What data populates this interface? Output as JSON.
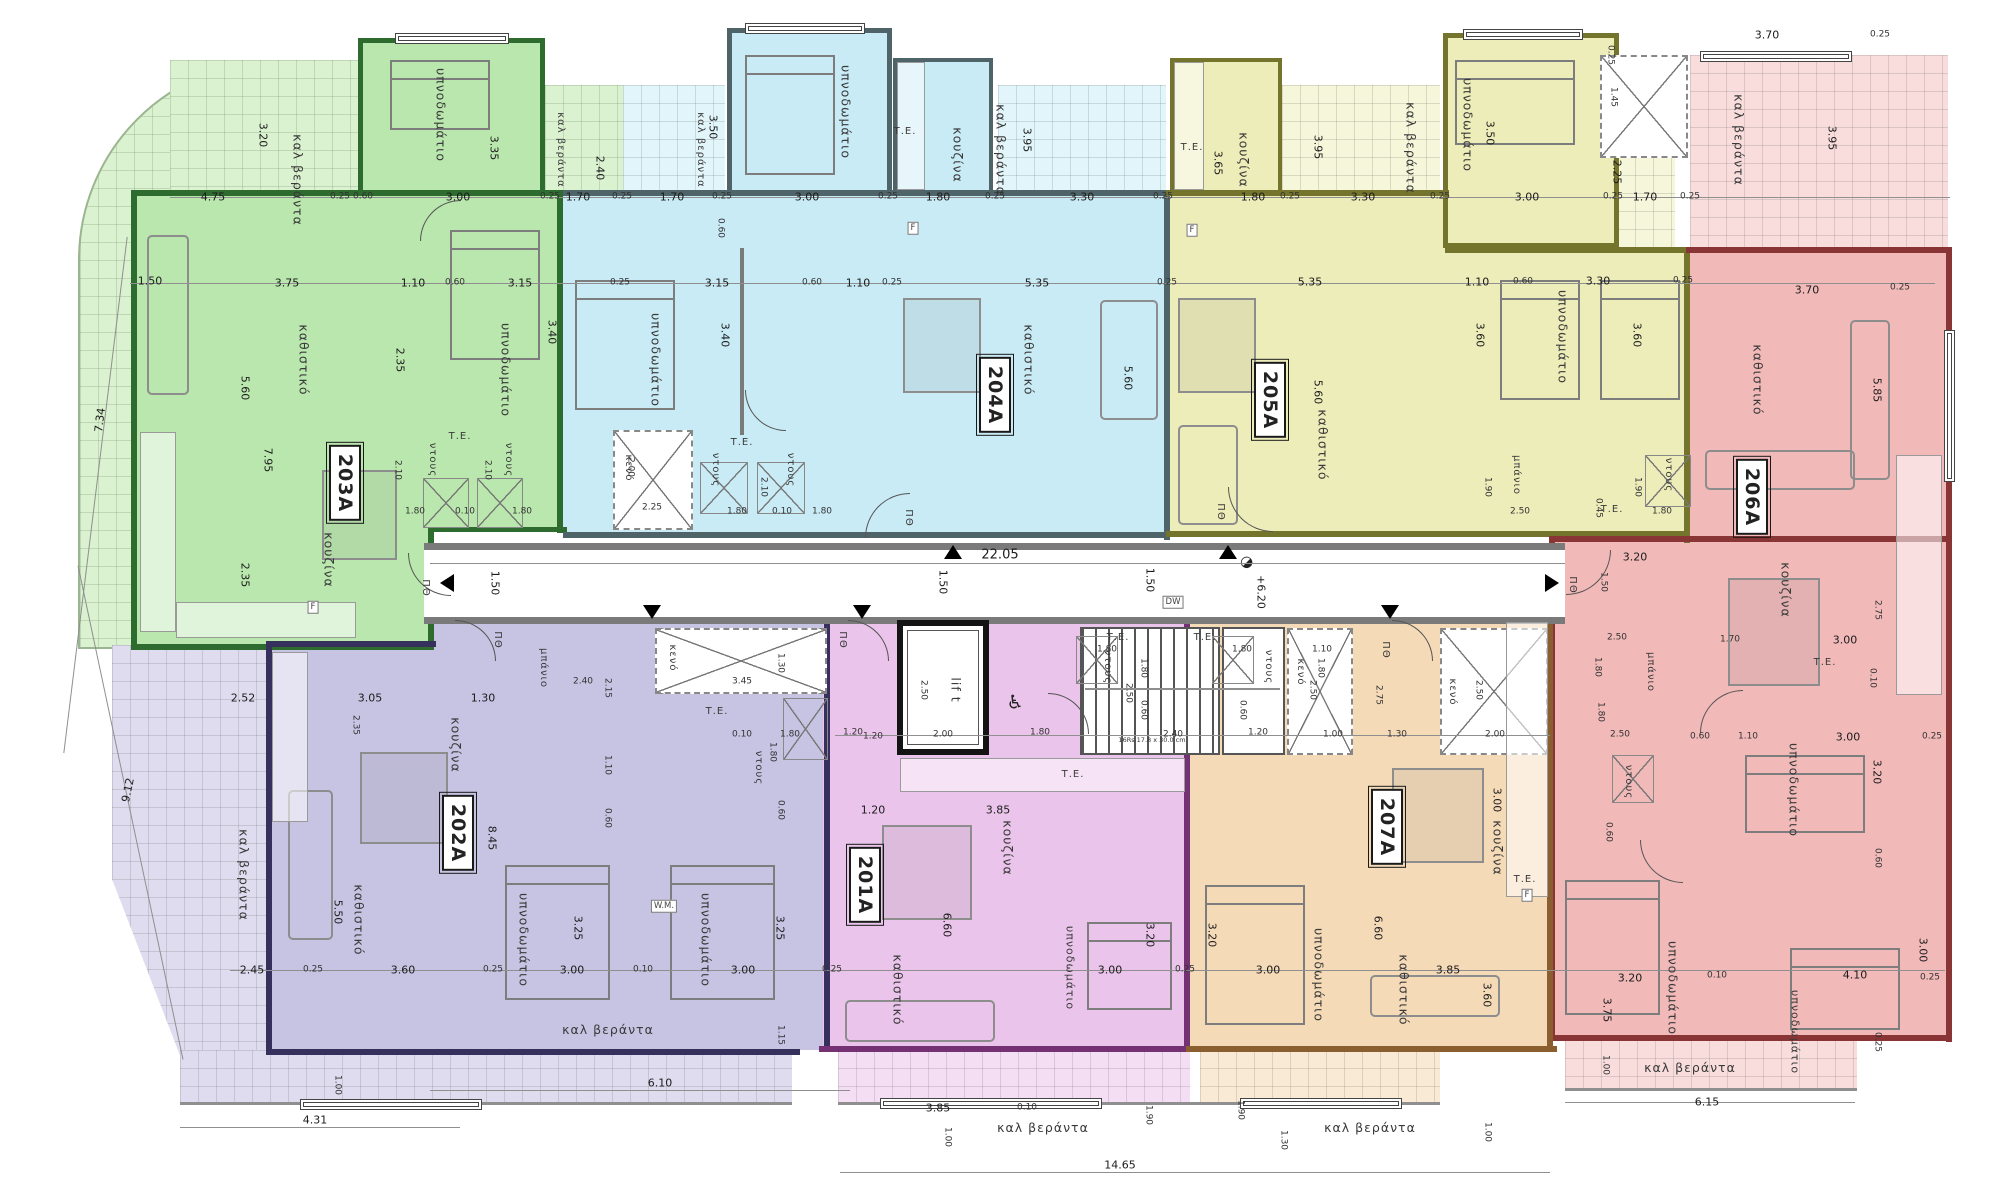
{
  "units": [
    "201A",
    "202A",
    "203A",
    "204A",
    "205A",
    "206A",
    "207A"
  ],
  "rooms": [
    "καλ  βεράντα",
    "υπνοδωμάτιο",
    "καθιστικό",
    "υπνοδωμάτιο",
    "κουζίνα",
    "ντους",
    "Τ.Ε.",
    "ντους",
    "κενό",
    "καλ βεράντα",
    "καλ βεράντα",
    "υπνοδωμάτιο",
    "Τ.Ε.",
    "κουζίνα",
    "καλ βεράντα",
    "υπνοδωμάτιο",
    "καθιστικό",
    "ντους",
    "Τ.Ε.",
    "ντους",
    "κουζίνα",
    "Τ.Ε.",
    "καλ βεράντα",
    "υπνοδωμάτιο",
    "υπνοδωμάτιο",
    "καθιστικό",
    "μπάνιο",
    "ντους",
    "Τ.Ε.",
    "καλ βεράντα",
    "καθιστικό",
    "κουζίνα",
    "μπάνιο",
    "ντους",
    "Τ.Ε.",
    "υπνοδωμάτιο",
    "υπνοδωμάτιο",
    "υπνοδωμάτιο",
    "καλ βεράντα",
    "κενό",
    "lif t",
    "κενό",
    "κενό",
    "ΠΘ",
    "ΠΘ",
    "ΠΘ",
    "ΠΘ",
    "ΠΘ",
    "ΠΘ",
    "ΠΘ",
    "μπάνιο",
    "κουζίνα",
    "ντους",
    "Τ.Ε.",
    "καλ βεράντα",
    "καθιστικό",
    "υπνοδωμάτιο",
    "υπνοδωμάτιο",
    "καλ βεράντα",
    "κουζίνα",
    "Τ.Ε.",
    "καθιστικό",
    "υπνοδωμάτιο",
    "ντους",
    "Τ.Ε.",
    "καλ βεράντα",
    "Τ.Ε.",
    "ντους",
    "υπνοδωμάτιο",
    "καθιστικό",
    "κουζίνα",
    "Τ.Ε.",
    "καλ βεράντα"
  ],
  "dims": [
    "4.75",
    "0.25",
    "0.60",
    "3.00",
    "0.25",
    "1.70",
    "0.25",
    "1.70",
    "0.25",
    "3.00",
    "0.25",
    "1.80",
    "0.25",
    "3.30",
    "0.25",
    "3.65",
    "1.80",
    "0.25",
    "3.30",
    "0.25",
    "3.00",
    "0.25",
    "1.70",
    "0.25",
    "3.70",
    "0.25",
    "3.20",
    "3.35",
    "2.40",
    "3.50",
    "0.60",
    "3.95",
    "3.95",
    "3.50",
    "2.25",
    "1.45",
    "0.25",
    "3.95",
    "1.50",
    "3.75",
    "1.10",
    "0.60",
    "3.15",
    "0.25",
    "3.15",
    "0.60",
    "1.10",
    "0.25",
    "5.35",
    "0.25",
    "5.35",
    "1.10",
    "0.60",
    "3.30",
    "0.25",
    "3.70",
    "0.25",
    "2.35",
    "5.60",
    "7.95",
    "3.40",
    "3.40",
    "5.60",
    "5.60",
    "3.60",
    "3.60",
    "5.85",
    "2.35",
    "2.10",
    "1.80",
    "0.10",
    "1.80",
    "2.10",
    "2.00",
    "2.25",
    "2.10",
    "1.80",
    "0.10",
    "1.80",
    "1.90",
    "2.50",
    "0.45",
    "1.90",
    "1.80",
    "22.05",
    "1.50",
    "1.50",
    "+6.20",
    "1.50",
    "1.20",
    "2.00",
    "2.50",
    "1.80",
    "2.40",
    "2.50",
    "1.20",
    "1.00",
    "2.50",
    "1.30",
    "2.75",
    "2.00",
    "2.50",
    "3.45",
    "1.30",
    "2.52",
    "3.05",
    "1.30",
    "2.35",
    "2.40",
    "2.15",
    "1.10",
    "0.60",
    "8.45",
    "5.50",
    "2.45",
    "0.25",
    "3.60",
    "0.25",
    "3.00",
    "0.10",
    "3.25",
    "3.25",
    "3.00",
    "0.25",
    "1.80",
    "0.10",
    "1.80",
    "0.60",
    "9.12",
    "7.34",
    "4.31",
    "1.00",
    "6.10",
    "1.15",
    "1.20",
    "1.20",
    "3.85",
    "6.60",
    "3.00",
    "3.20",
    "0.25",
    "3.85",
    "0.10",
    "1.00",
    "1.90",
    "1.80",
    "1.80",
    "0.60",
    "1.80",
    "1.10",
    "1.80",
    "0.60",
    "3.20",
    "3.00",
    "6.60",
    "3.85",
    "3.60",
    "3.00",
    "1.90",
    "1.00",
    "1.30",
    "14.65",
    "3.20",
    "1.50",
    "2.50",
    "1.80",
    "1.70",
    "3.00",
    "2.75",
    "0.10",
    "2.50",
    "1.80",
    "0.60",
    "1.10",
    "3.00",
    "3.20",
    "0.25",
    "0.60",
    "0.60",
    "3.75",
    "3.20",
    "0.10",
    "4.10",
    "3.00",
    "0.25",
    "1.00",
    "6.15",
    "0.25"
  ],
  "marks": [
    "F",
    "F",
    "F",
    "F",
    "DW",
    "W.M."
  ],
  "notes": {
    "stairs": "16Rs 17.8 x 30.0 cm"
  },
  "icons": {
    "wheelchair": "♿",
    "level_marker": "◑"
  },
  "colors": {
    "green": "#b9e7ad",
    "blue": "#c9ebf6",
    "yellow": "#ededba",
    "red": "#f2b9b9",
    "purple": "#c7c3e3",
    "magenta": "#eac4ea",
    "orange": "#f5dab8",
    "wall": "#7a7a7a"
  }
}
